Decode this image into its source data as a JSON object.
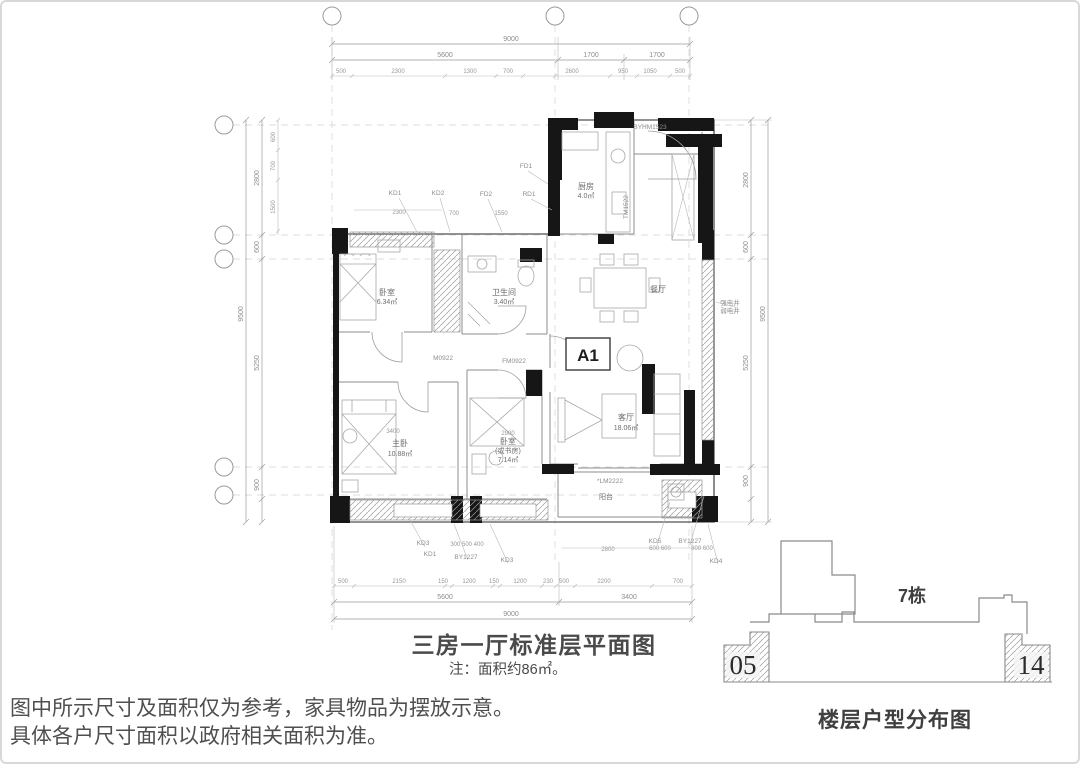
{
  "plan": {
    "unit_label": "A1",
    "title": "三房一厅标准层平面图",
    "note": "注：面积约86㎡。",
    "rooms": {
      "bedroom2": {
        "name": "卧室",
        "area": "6.34㎡"
      },
      "bath": {
        "name": "卫生间",
        "area": "3.40㎡"
      },
      "kitchen": {
        "name": "厨房",
        "area": "4.0㎡"
      },
      "dining": {
        "name": "餐厅"
      },
      "living": {
        "name": "客厅",
        "area": "18.06㎡"
      },
      "master": {
        "name": "主卧",
        "area": "10.88㎡"
      },
      "study": {
        "name": "卧室",
        "alt": "(或书房)",
        "area": "7.14㎡"
      },
      "balcony": {
        "name": "阳台"
      }
    },
    "dims": {
      "top_total": "9000",
      "top_majors": [
        "5600",
        "1700",
        "1700"
      ],
      "top_minors": [
        "500",
        "2300",
        "1300",
        "700",
        "2600",
        "950",
        "1050",
        "500"
      ],
      "bottom_minors": [
        "500",
        "2150",
        "150",
        "1200",
        "150",
        "1200",
        "230",
        "500",
        "2200",
        "700"
      ],
      "bottom_majors": [
        "5600",
        "3400"
      ],
      "bottom_total": "9000",
      "left_minors": [
        "600",
        "700",
        "1500"
      ],
      "left_majors": [
        "2800",
        "600",
        "5250",
        "900"
      ],
      "left_total": "9500",
      "right_majors": [
        "2800",
        "600",
        "5250",
        "900"
      ],
      "right_total": "9500",
      "interior": [
        "2300",
        "700",
        "1550",
        "3400",
        "2900",
        "2800",
        "300 500 400",
        "600 600",
        "800 600"
      ]
    },
    "codes": {
      "kd1": "KD1",
      "kd2": "KD2",
      "fd2": "FD2",
      "fd1": "FD1",
      "rd1": "RD1",
      "entry_door": "BYHM1523",
      "tm": "TM1522",
      "m0922": "M0922",
      "fm0922": "FM0922",
      "lm": "*LM2222",
      "shaft_strong": "强电井",
      "shaft_weak": "弱电井",
      "kd3a": "KD3",
      "kd1b": "KD1",
      "by1227a": "BY1227",
      "kd3b": "KD3",
      "kd5": "KD5",
      "by1227b": "BY1227",
      "kd4": "KD4"
    }
  },
  "key_plan": {
    "building": "7栋",
    "unit_left": "05",
    "unit_right": "14",
    "caption": "楼层户型分布图"
  },
  "disclaimer": {
    "line1": "图中所示尺寸及面积仅为参考，家具物品为摆放示意。",
    "line2": "具体各户尺寸面积以政府相关面积为准。"
  }
}
